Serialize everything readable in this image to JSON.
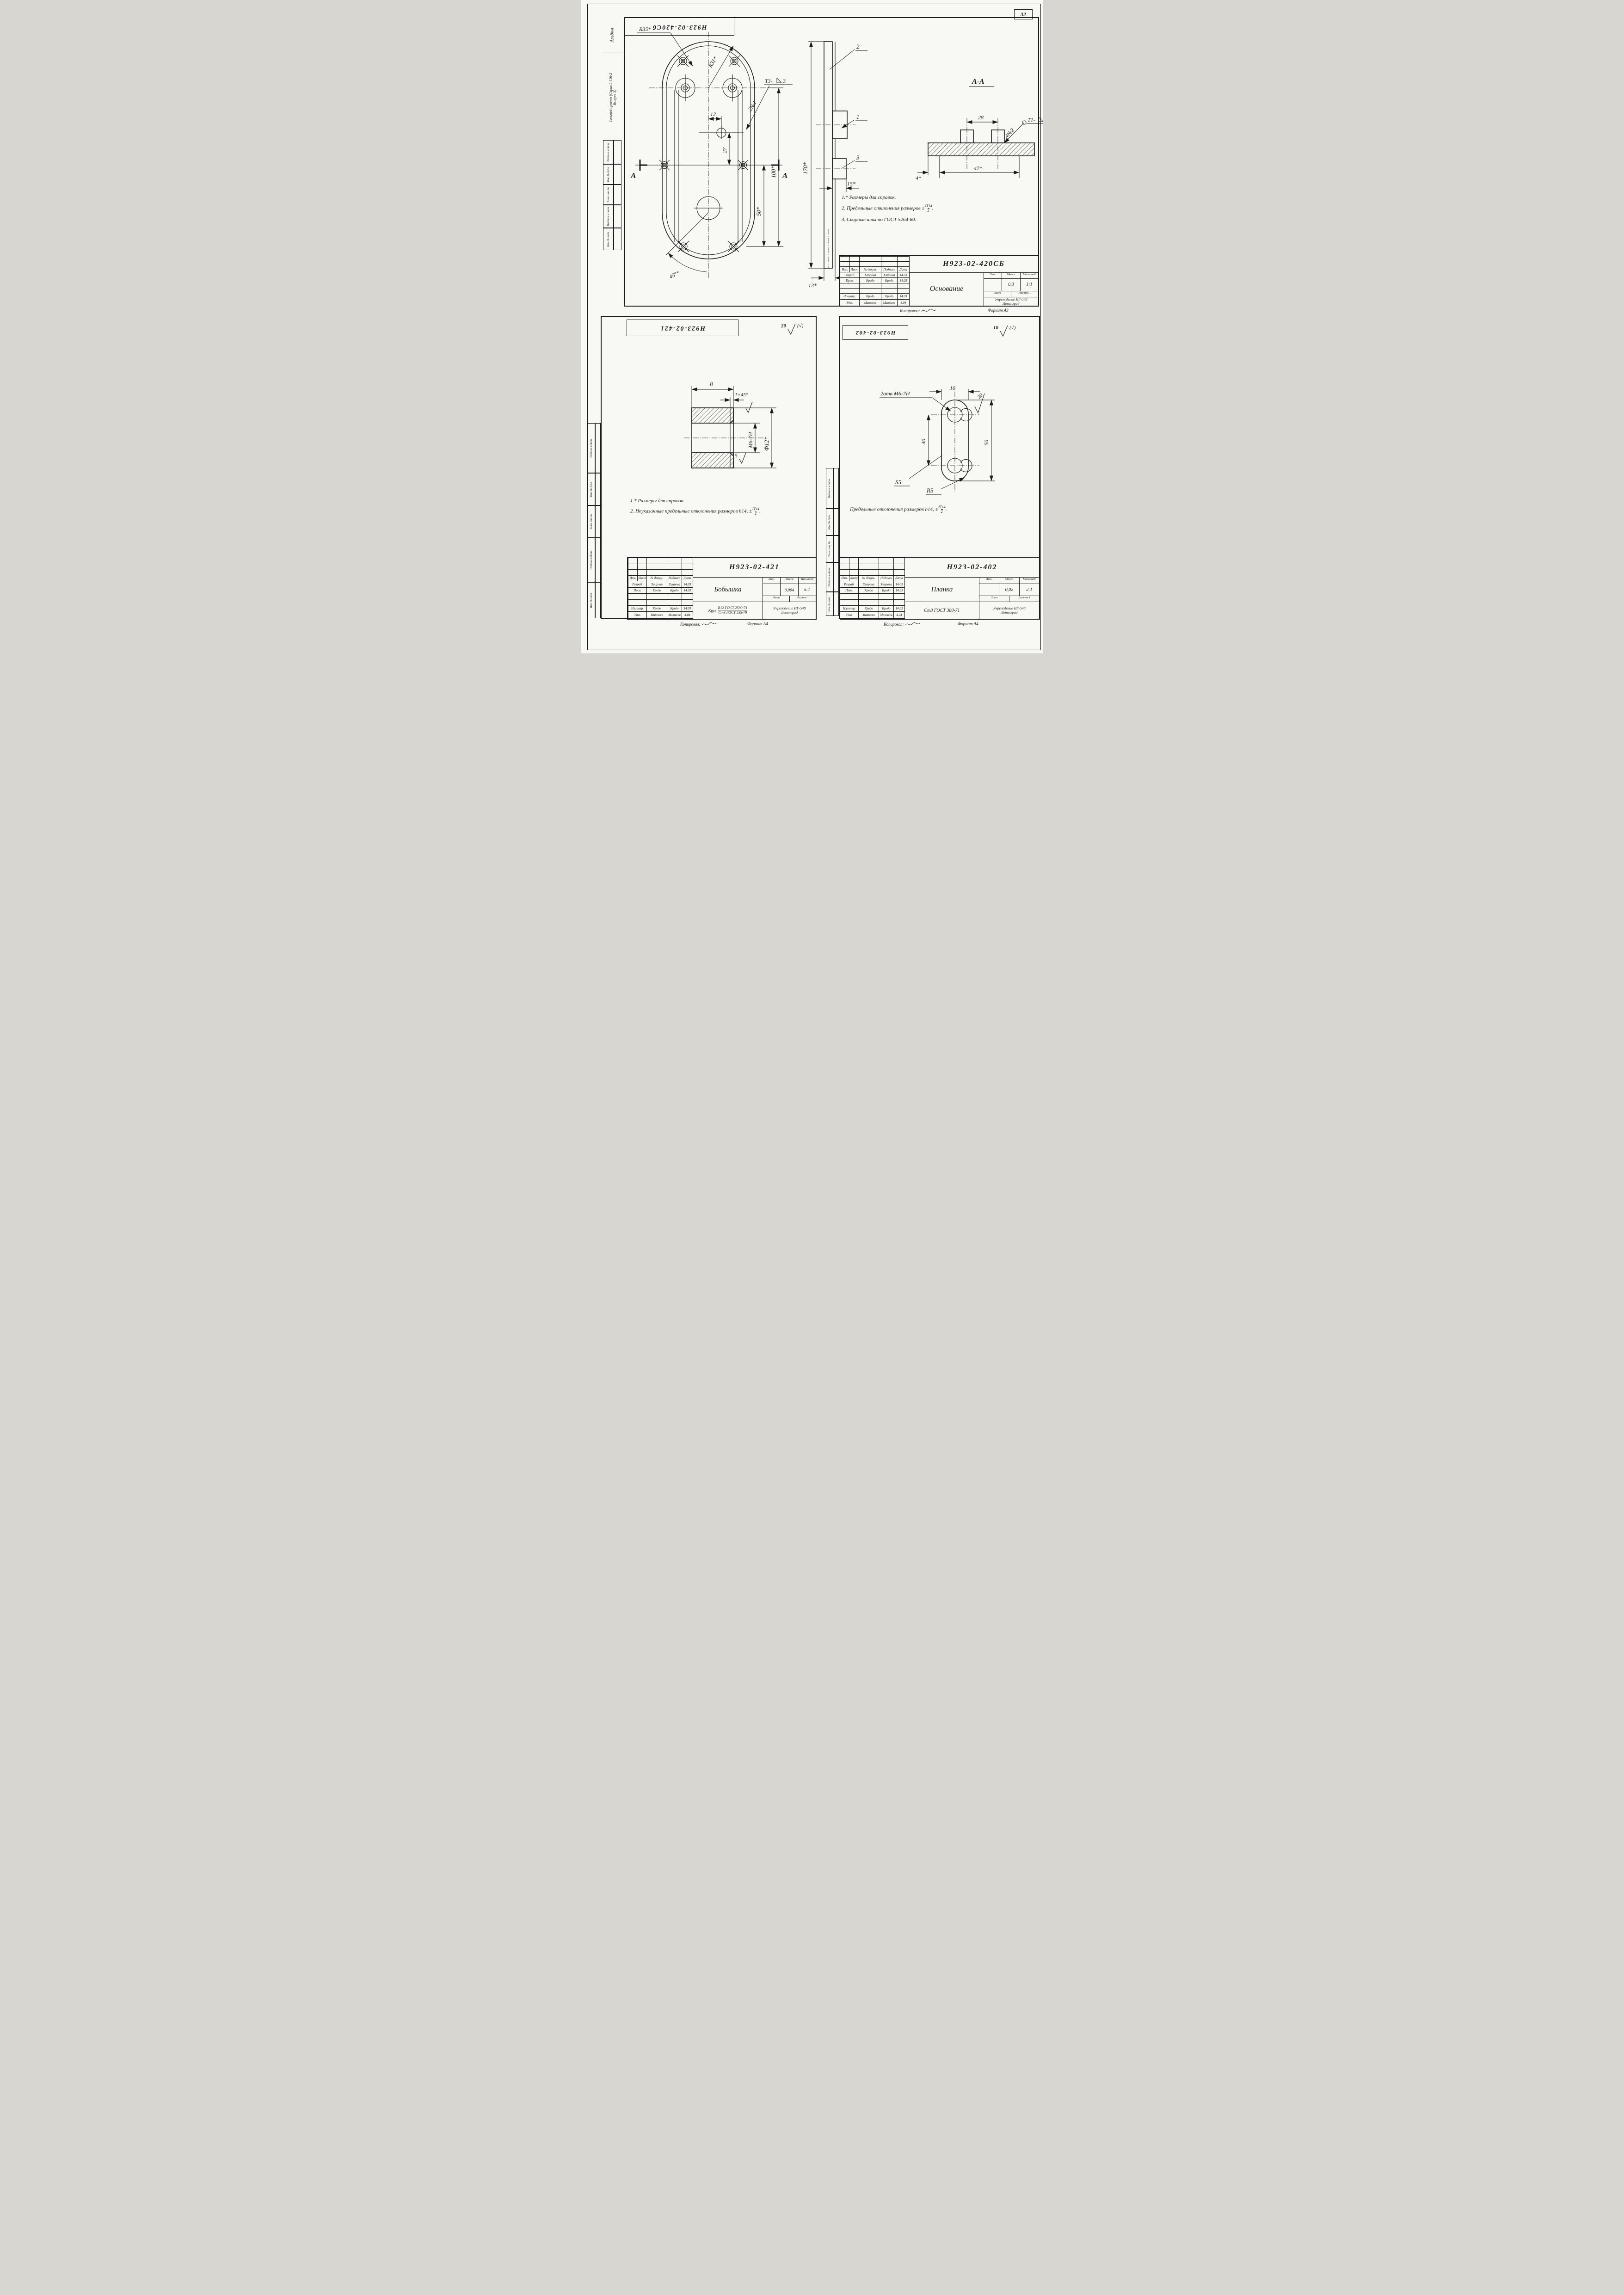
{
  "page": {
    "number": "32",
    "album": "Альбом",
    "project_line1": "Типовой проект (Серия 5.416-2",
    "project_line2": "Выпуск 3)",
    "side_labels": [
      "Подпись и дата",
      "Инв. № дубл.",
      "Взам. инв. №",
      "Подпись и дата",
      "Инв. № подл."
    ],
    "copied": "Копировал:"
  },
  "tb": {
    "header": [
      "Изм.",
      "Лист",
      "№ докум.",
      "Подпись",
      "Дата"
    ],
    "lit": "Лит.",
    "massa": "Масса",
    "masshtab": "Масштаб",
    "list": "Лист",
    "listov": "Листов 1",
    "org": "Учреждение ИГ-548",
    "city": "Ленинград",
    "rows": [
      {
        "role": "Разраб.",
        "name": "Хаирова",
        "sign": "Хаирова",
        "date": "14.03"
      },
      {
        "role": "Пров.",
        "name": "Кредо",
        "sign": "Кредо",
        "date": "14.03"
      },
      {
        "role": "Н.контр.",
        "name": "Кредо",
        "sign": "Кредо",
        "date": "14.03"
      },
      {
        "role": "Утв.",
        "name": "Матвеев",
        "sign": "Матвеев",
        "date": "4.04"
      }
    ]
  },
  "frac": {
    "num": "JT14",
    "den": "2",
    "dot": "."
  },
  "d1": {
    "stamp": "Н923-02-420Сб",
    "doc": "Н923-02-420СБ",
    "name": "Основание",
    "mass": "0,3",
    "scale": "1:1",
    "format": "Формат А3",
    "section": "А-А",
    "notes": {
      "n1": "1.* Размеры для справок.",
      "n2": "2. Предельные отклонения размеров ±",
      "n3": "3. Сварные швы по ГОСТ 5264-80."
    },
    "dims": {
      "r35": "R35*",
      "r31": "R31*",
      "n12": "12",
      "n27": "27",
      "n50": "50*",
      "n100": "100*",
      "n170": "170*",
      "n15": "15*",
      "n13": "13*",
      "a45": "45°*",
      "a": "А",
      "qty1": "2№1",
      "t3": "Т3-",
      "t3n": "3",
      "c1": "1",
      "c2": "2",
      "c3": "3",
      "n28": "28",
      "n4": "4*",
      "n47": "47*",
      "qty2": "4№2",
      "t1": "Т1-",
      "t1n": "3"
    }
  },
  "d2": {
    "stamp": "Н923-02-421",
    "doc": "Н923-02-421",
    "name": "Бобышка",
    "mass": "0,004",
    "scale": "5:1",
    "format": "Формат А4",
    "rough": "20",
    "rough_paren": "(√)",
    "material_prefix": "Круг",
    "material_num": "В12 ГОСТ 2590-71",
    "material_den": "Ст3 ГОСТ 535-79",
    "notes": {
      "n1": "1.* Размеры для справок.",
      "n2": "2. Неуказанные предельные отклонения размеров h14, ±"
    },
    "dims": {
      "n8": "8",
      "ch": "1×45°",
      "m6": "М6-7Н",
      "n5": "5",
      "f12": "Ф12*"
    }
  },
  "d3": {
    "stamp": "Н923-02-402",
    "doc": "Н923-02-402",
    "name": "Планка",
    "mass": "0,02",
    "scale": "2:1",
    "format": "Формат А4",
    "rough": "10",
    "rough_paren": "(√)",
    "material": "Ст3 ГОСТ 380-71",
    "note": "Предельные отклонения размеров h14, ±",
    "dims": {
      "holes": "2отв.М6-7Н",
      "n10": "10",
      "r20": "20",
      "n40": "40",
      "n50": "50",
      "s5": "S5",
      "r5": "R5"
    }
  }
}
